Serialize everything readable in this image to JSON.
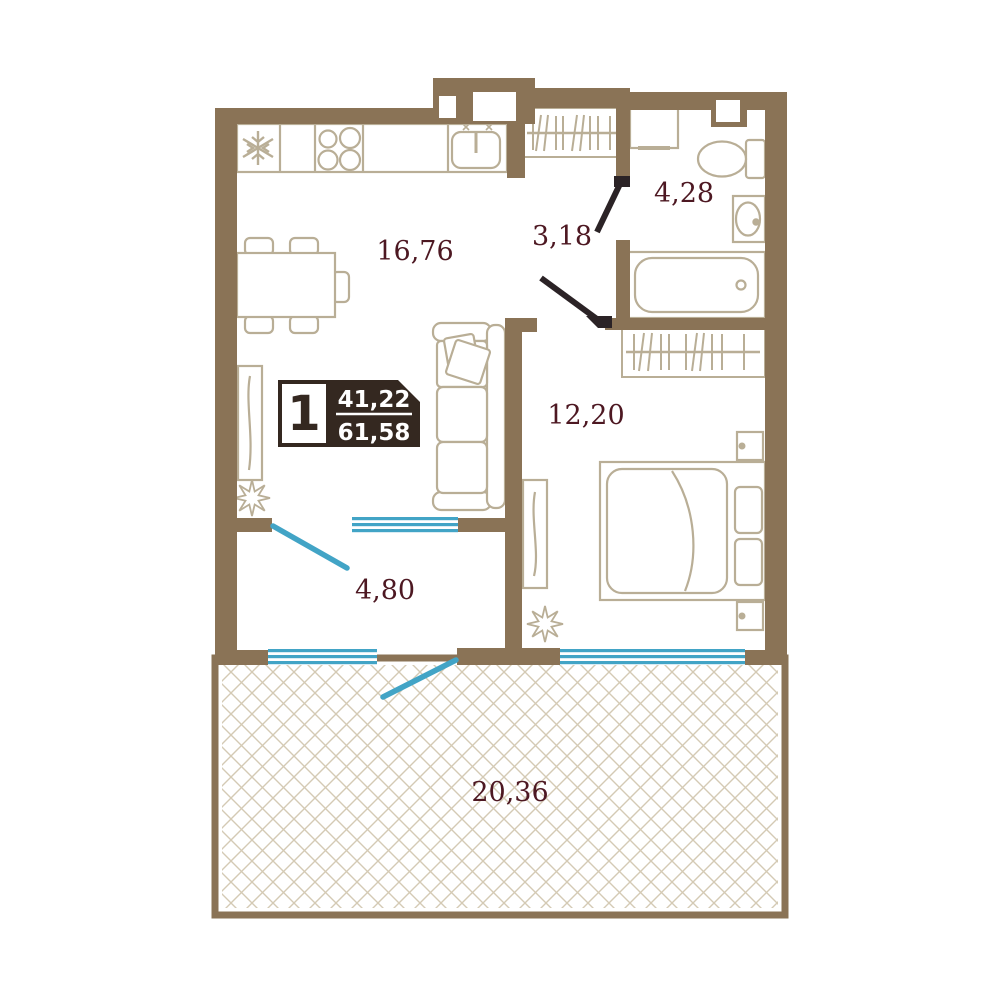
{
  "plan": {
    "title": "apartment-floor-plan",
    "rooms": [
      {
        "name": "kitchen-living-room",
        "area": "16,76"
      },
      {
        "name": "hallway",
        "area": "3,18"
      },
      {
        "name": "bathroom",
        "area": "4,28"
      },
      {
        "name": "bedroom",
        "area": "12,20"
      },
      {
        "name": "entry-hall",
        "area": "4,80"
      },
      {
        "name": "terrace",
        "area": "20,36"
      }
    ],
    "badge": {
      "rooms_count": "1",
      "living_area": "41,22",
      "total_area": "61,58"
    },
    "icons": [
      "fridge-snowflake-icon",
      "stove-burners-icon",
      "kitchen-sink-icon",
      "wardrobe-hangers-icon",
      "washing-machine-icon",
      "toilet-icon",
      "wash-basin-icon",
      "bathtub-icon",
      "bed-icon",
      "sofa-icon",
      "dining-table-icon",
      "plant-icon",
      "window-glazing",
      "door-leaf"
    ],
    "colors": {
      "wall": "#8a7356",
      "furniture_outline": "#b9ae96",
      "accent_blue": "#42a4c6",
      "dark_door": "#2b2326",
      "label_text": "#4d1822",
      "badge_background": "#342820",
      "hatch_line": "#d4cab4"
    }
  }
}
